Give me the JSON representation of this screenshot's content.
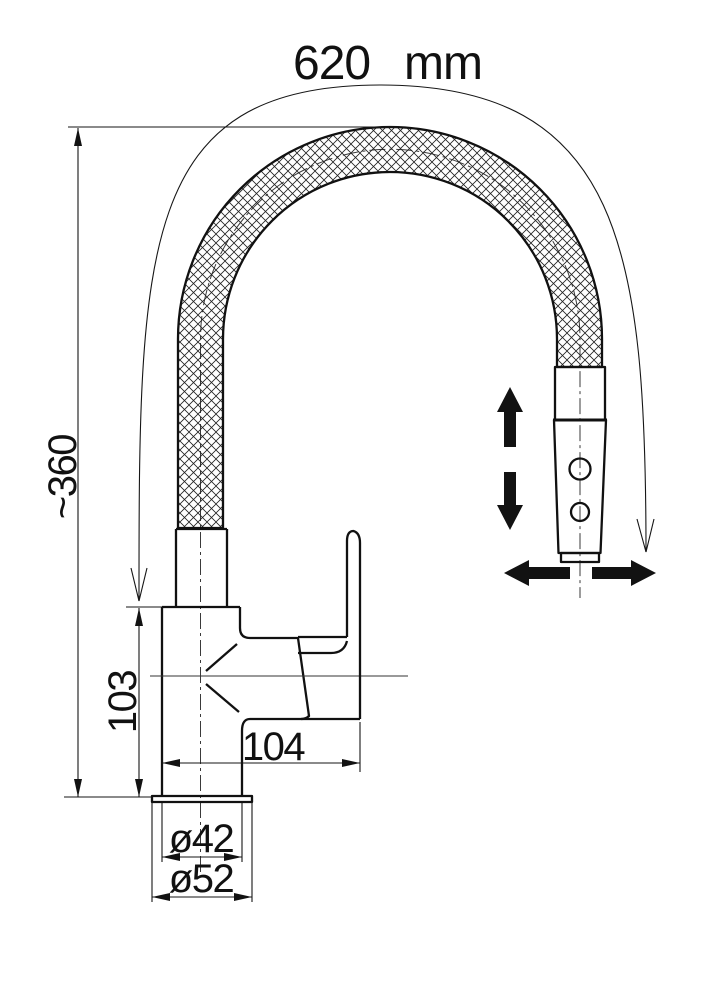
{
  "drawing": {
    "type": "faucet-technical-drawing",
    "dimensions": {
      "hose_length": {
        "value": "620",
        "unit": "mm"
      },
      "overall_height": "~360",
      "body_height": "103",
      "spout_reach": "104",
      "shank_diameter": "ø42",
      "base_diameter": "ø52"
    },
    "line_color": "#111111",
    "background": "#ffffff"
  }
}
